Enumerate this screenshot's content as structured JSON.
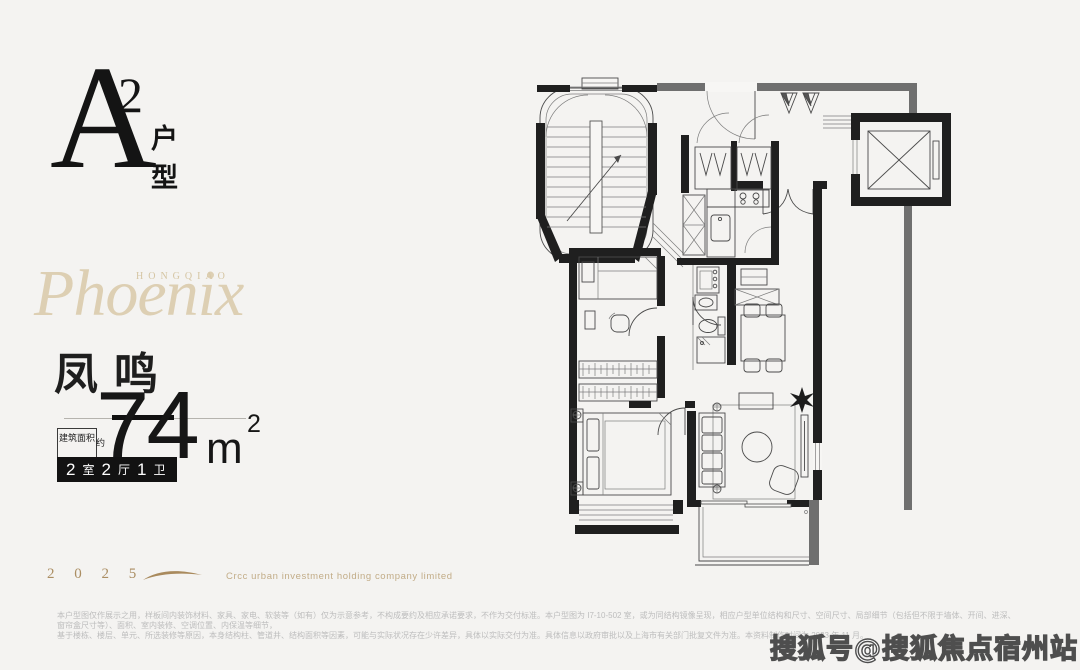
{
  "colors": {
    "background": "#f4f3f1",
    "ink": "#1c1c1c",
    "gold": "#b3966b",
    "beige": "#d9c9a9",
    "badge_bg": "#121212"
  },
  "unit_mark": {
    "letter": "A",
    "superscript": "2",
    "type_vertical": "户型"
  },
  "brand": {
    "eyebrow": "HONGQIAO",
    "name": "Phoenix",
    "chinese": "凤鸣"
  },
  "area": {
    "note": "建筑面积",
    "note_suffix": "约",
    "value": "74",
    "unit": "m",
    "unit_sup": "2"
  },
  "badge": {
    "parts": [
      {
        "num": "2",
        "label": "室"
      },
      {
        "num": "2",
        "label": "厅"
      },
      {
        "num": "1",
        "label": "卫"
      }
    ]
  },
  "footer": {
    "year": "2 0 2 5",
    "company": "Crcc urban investment holding company limited"
  },
  "disclaimer": {
    "line1": "本户型图仅作展示之用，样板间内装饰材料、家具、家电、软装等（如有）仅为示意参考，不构成要约及相应承诺要求，不作为交付标准。本户型图为 I7-10-502 室，或为同结构镜像呈现，相应户型单位结构和尺寸、空间尺寸、局部细节（包括但不限于墙体、开间、进深、窗帘盒尺寸等）、面积、室内装修、空调位置、内保温等细节，",
    "line2": "基于楼栋、楼层、单元、所选装修等原因，本身结构柱、管道井、结构面积等因素，可能与实际状况存在少许差异，具体以实际交付为准。具体信息以政府审批以及上海市有关部门批复文件为准。本资料制作时间为 2023 年 11 月。"
  },
  "watermark": "搜狐号@搜狐焦点宿州站",
  "floorplan": {
    "features": [
      "stairwell",
      "elevator",
      "shaft-triangles",
      "entry-double-door",
      "pantry-closets",
      "kitchen",
      "stove",
      "sink",
      "refrigerator",
      "washer",
      "bathroom",
      "toilet",
      "shower",
      "bedroom",
      "single-bed",
      "desk-chair",
      "walk-in-closet",
      "master-bedroom",
      "double-bed",
      "nightstands",
      "living-room",
      "sofa",
      "coffee-table",
      "tv",
      "armchair",
      "plant",
      "dining-table",
      "dining-chairs",
      "balcony",
      "bay-window"
    ]
  }
}
